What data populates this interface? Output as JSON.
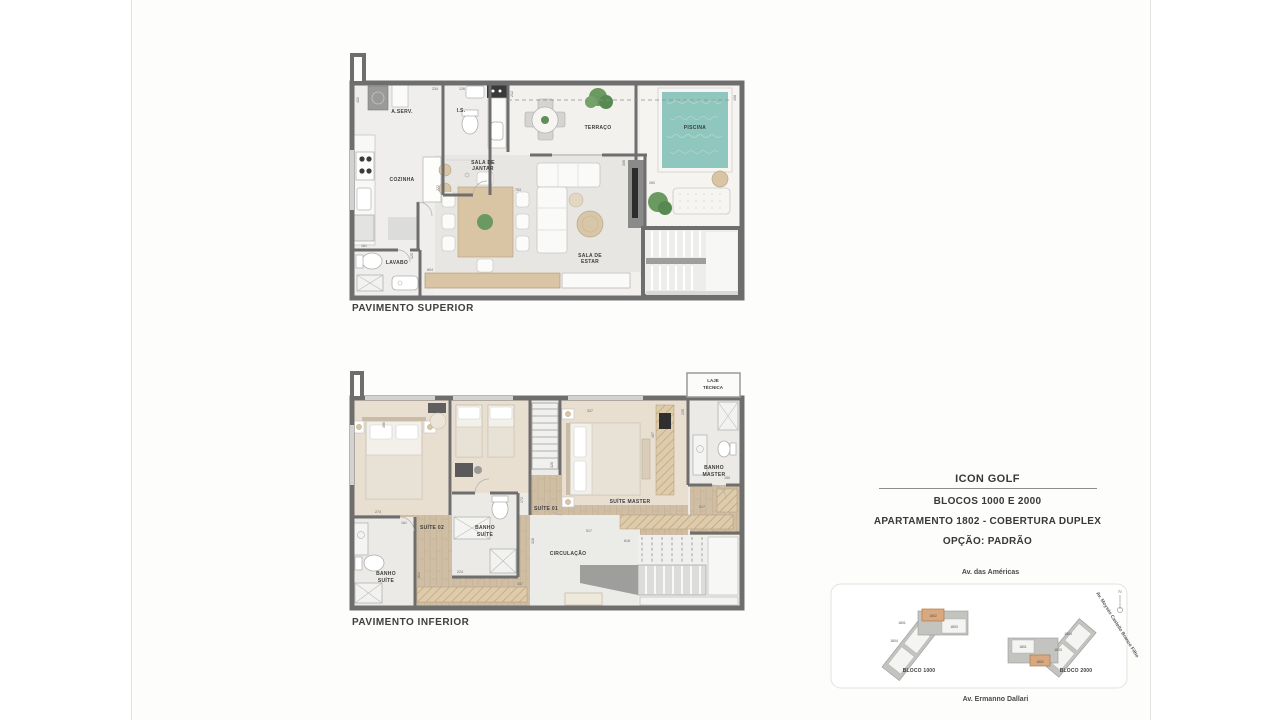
{
  "plans": {
    "upper": {
      "caption": "PAVIMENTO SUPERIOR",
      "rooms": {
        "aserv": "A.SERV.",
        "is": "I.S.",
        "cozinha": "COZINHA",
        "sala_jantar": [
          "SALA DE",
          "JANTAR"
        ],
        "terraco": "TERRAÇO",
        "piscina": "PISCINA",
        "sala_estar": [
          "SALA DE",
          "ESTAR"
        ],
        "lavabo": "LAVABO"
      },
      "dims": [
        "402",
        "234",
        "126",
        "212",
        "753",
        "222",
        "604",
        "161",
        "125",
        "306",
        "260",
        "408"
      ]
    },
    "lower": {
      "caption": "PAVIMENTO INFERIOR",
      "rooms": {
        "laje": [
          "LAJE",
          "TÉCNICA"
        ],
        "suite02": "SUÍTE 02",
        "banho_suite_1": [
          "BANHO",
          "SUÍTE"
        ],
        "banho_suite_2": [
          "BANHO",
          "SUÍTE"
        ],
        "suite01": "SUÍTE 01",
        "suite_master": "SUÍTE MASTER",
        "banho_master": [
          "BANHO",
          "MASTER"
        ],
        "circulacao": "CIRCULAÇÃO"
      },
      "dims": [
        "306",
        "274",
        "161",
        "224",
        "172",
        "326",
        "307",
        "614",
        "328",
        "337",
        "407",
        "235",
        "150",
        "517",
        "618",
        "517"
      ]
    }
  },
  "title_block": {
    "project": "ICON GOLF",
    "blocks": "BLOCOS 1000 E 2000",
    "apartment": "APARTAMENTO 1802 - COBERTURA DUPLEX",
    "option": "OPÇÃO: PADRÃO"
  },
  "site_plan": {
    "street_top": "Av. das Américas",
    "street_right": "Av. Moysés Castello Branco Filho",
    "street_bottom": "Av. Ermanno Dallari",
    "north": "N",
    "bloco_1000": {
      "label": "BLOCO 1000",
      "units": {
        "u1801": "1801",
        "u1802": "1802",
        "u1803": "1803",
        "u1804": "1804"
      }
    },
    "bloco_2000": {
      "label": "BLOCO 2000",
      "units": {
        "u1801": "1801",
        "u1802": "1802",
        "u1803": "1803",
        "u1804": "1804"
      }
    }
  },
  "colors": {
    "wall": "#6e6e6e",
    "pool": "#8fc6be",
    "wood": "#cfbda4",
    "highlight_unit": "#d9a87f"
  }
}
